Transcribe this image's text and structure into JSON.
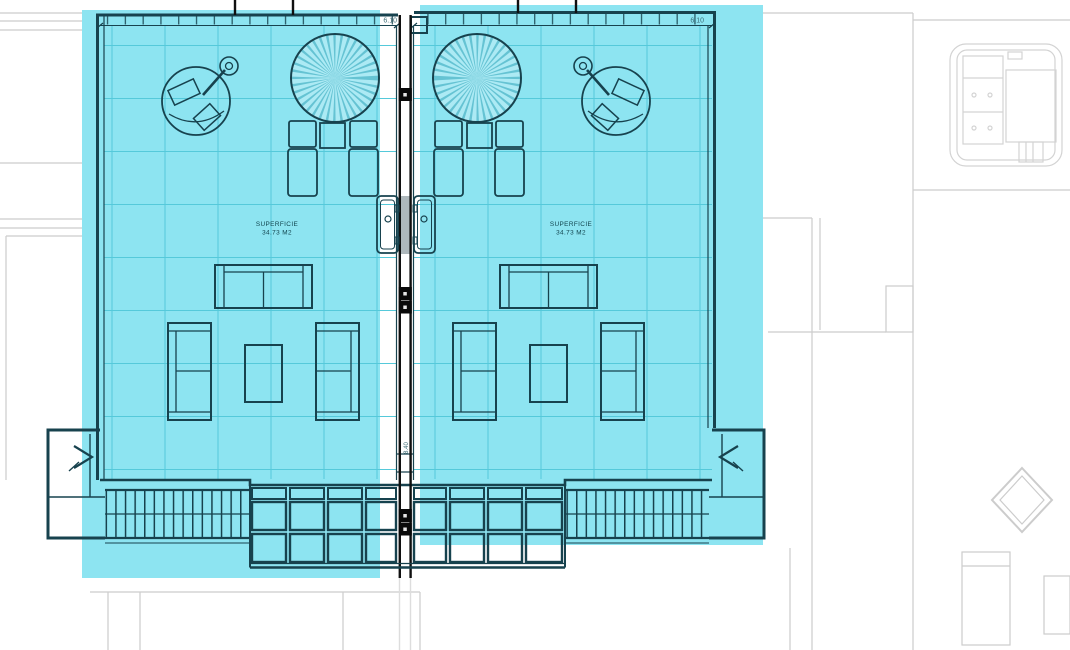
{
  "drawing": {
    "type": "architectural-floor-plan",
    "description": "Roof terrace solarium plan: two mirrored units highlighted in cyan, adjacent context in faint gray",
    "units": [
      {
        "id": "left",
        "area_label": "SUPERFICIE",
        "area_value": "34.73 M2",
        "width_dimension": "6.10"
      },
      {
        "id": "right",
        "area_label": "SUPERFICIE",
        "area_value": "34.73 M2",
        "width_dimension": "6.10"
      }
    ],
    "center_dimension": "8.40",
    "features": [
      "parasol",
      "outdoor-shower",
      "sun-loungers",
      "side-table",
      "sofa",
      "armchairs",
      "coffee-table",
      "wall-panel",
      "pergola-grid",
      "slat-railing",
      "stairs-landing",
      "jacuzzi",
      "diamond-marker"
    ],
    "colors": {
      "highlight": "#8DE4F1",
      "line": "#17424E",
      "grid": "#55C9DA",
      "context": "#CCCCCC",
      "bg": "#FFFFFF"
    }
  }
}
